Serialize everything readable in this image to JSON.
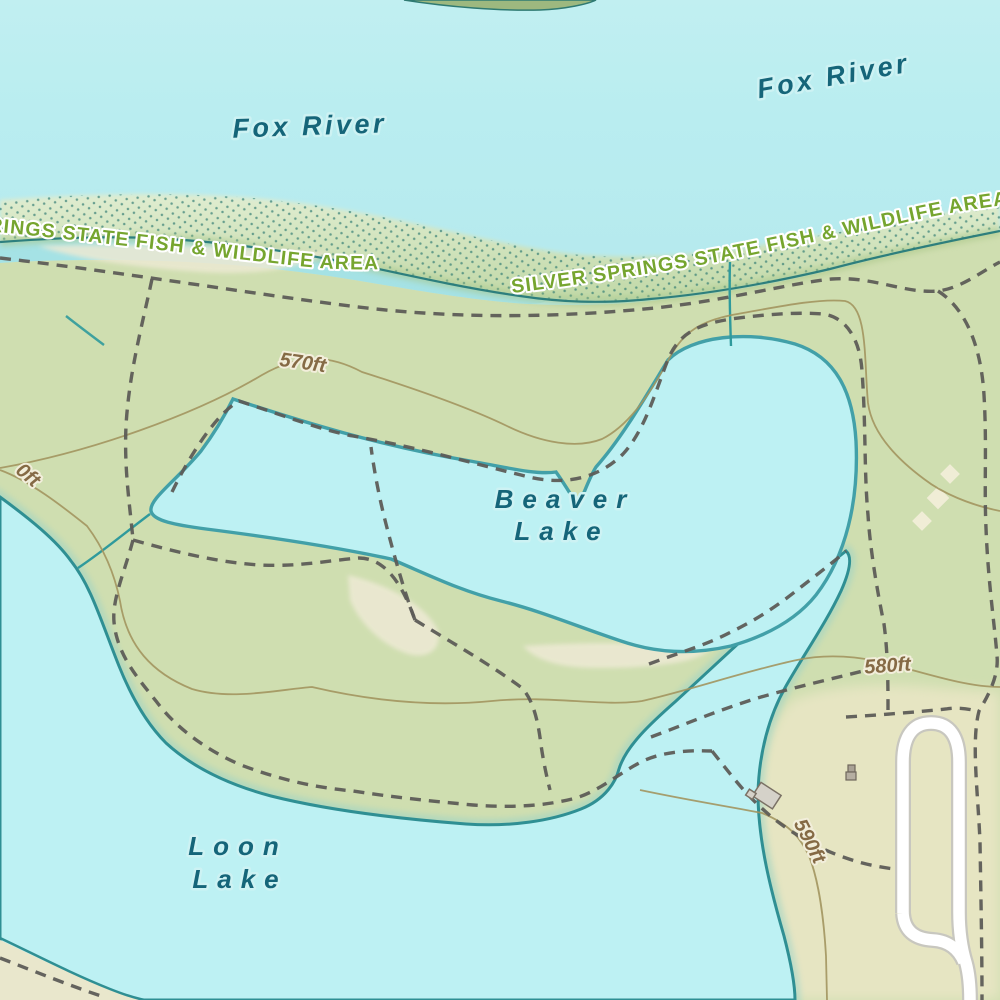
{
  "map": {
    "type": "topographic-map",
    "labels": {
      "river_upper": "Fox River",
      "river_left": "Fox River",
      "park_label_left": "RINGS STATE FISH & WILDLIFE AREA",
      "park_label_right": "SILVER SPRINGS STATE FISH & WILDLIFE AREA",
      "beaver_lake_line1": "Beaver",
      "beaver_lake_line2": "Lake",
      "loon_lake_line1": "Loon",
      "loon_lake_line2": "Lake",
      "contour_570": "570ft",
      "contour_580": "580ft",
      "contour_590": "590ft",
      "contour_partial": "0ft"
    },
    "colors": {
      "water": "#b9edf0",
      "lake_fill": "#bdf1f3",
      "channel_fill": "#a5e2e5",
      "land_green": "#cfdeb0",
      "land_cream": "#e6e5c2",
      "patch_cream": "#ece9d3",
      "wetland_light": "#dfeccf",
      "wetland_dark": "#c0d8a6",
      "wetland_dot": "#2f7a72",
      "shore_stroke": "#1f7578",
      "lake_stroke": "#42a0a8",
      "loon_stroke": "#2f8f93",
      "contour_line": "#a2955f",
      "contour_label": "#856a45",
      "trail": "#5d5c57",
      "road_fill": "#ffffff",
      "road_casing": "#c8c7bf",
      "water_label": "#156579",
      "park_label": "#76a52f",
      "building_fill": "#d5d2c9",
      "building_stroke": "#7a7165",
      "stream": "#2f9a9c"
    }
  }
}
